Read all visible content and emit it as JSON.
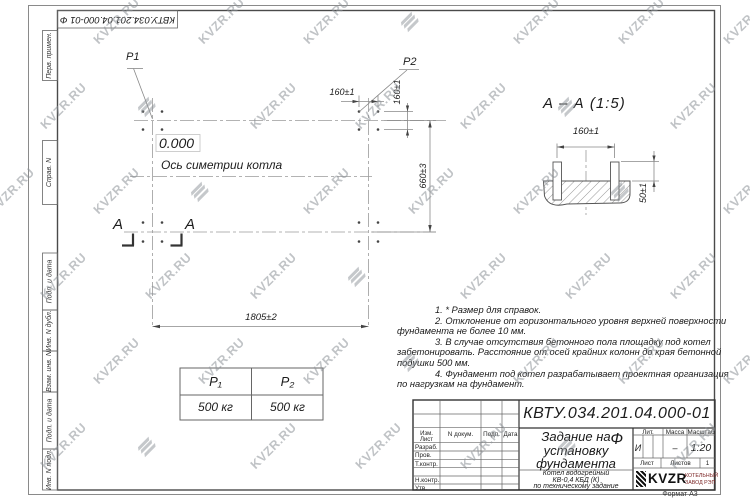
{
  "watermark": {
    "text": "KVZR.RU"
  },
  "stamp_top": {
    "text": "КВТУ.034.201.04.000-01 Ф"
  },
  "margin_labels": {
    "items": [
      "Перв. примен.",
      "Справ. N",
      "Подп. и дата",
      "Инв. N дубл.",
      "Взам. инв. N",
      "Подп. и дата",
      "Инв. N подл."
    ]
  },
  "plan": {
    "p1": "P1",
    "p2": "P2",
    "level": "0.000",
    "axis_label": "Ось симетрии котла",
    "dim_width": "1805±2",
    "dim_height": "660±3",
    "dim_bolt_x": "160±1",
    "dim_bolt_y": "160±1",
    "section_letter_left": "A",
    "section_letter_right": "A"
  },
  "section": {
    "title": "А – А (1:5)",
    "dim_width": "160±1",
    "dim_height": "50±1"
  },
  "load_table": {
    "headers": [
      "P₁",
      "P₂"
    ],
    "values": [
      "500 кг",
      "500 кг"
    ]
  },
  "notes": {
    "lines": [
      "1.  * Размер для справок.",
      "2.  Отклонение от горизонтального уровня верхней поверхности",
      "фундамента не более 10 мм.",
      "3.  В случае отсутствия бетонного пола площадку под котел",
      "забетонировать.  Расстояние от осей крайних колонн до края бетонной",
      "подушки 500 мм.",
      "4.  Фундамент под котел разрабатывает проектная организация",
      "по нагрузкам на фундамент."
    ]
  },
  "titleblock": {
    "designation": "КВТУ.034.201.04.000-01 Ф",
    "doc_title_lines": [
      "Задание на",
      "установку",
      "фундамента"
    ],
    "product_lines": [
      "Котел водогрейный",
      "КВ-0,4  КБД  (К)",
      "по техническому задание"
    ],
    "header_cols": [
      "Изм. Лист",
      "N докум.",
      "Подп.",
      "Дата"
    ],
    "rows": [
      "Разраб.",
      "Пров.",
      "Т.контр.",
      "Н.контр.",
      "Утв."
    ],
    "lit_label": "Лит.",
    "mass_label": "Масса",
    "scale_label": "Масштаб",
    "lit_value": "И",
    "mass_value": "–",
    "scale_value": "1:20",
    "sheet_label": "Лист",
    "sheets_label": "Листов",
    "sheets_value": "1",
    "company": {
      "mark": "KVZR",
      "name_line1": "КОТЕЛЬНЫЙ",
      "name_line2": "ЗАВОД РЭП"
    },
    "format_label": "Формат А3"
  }
}
